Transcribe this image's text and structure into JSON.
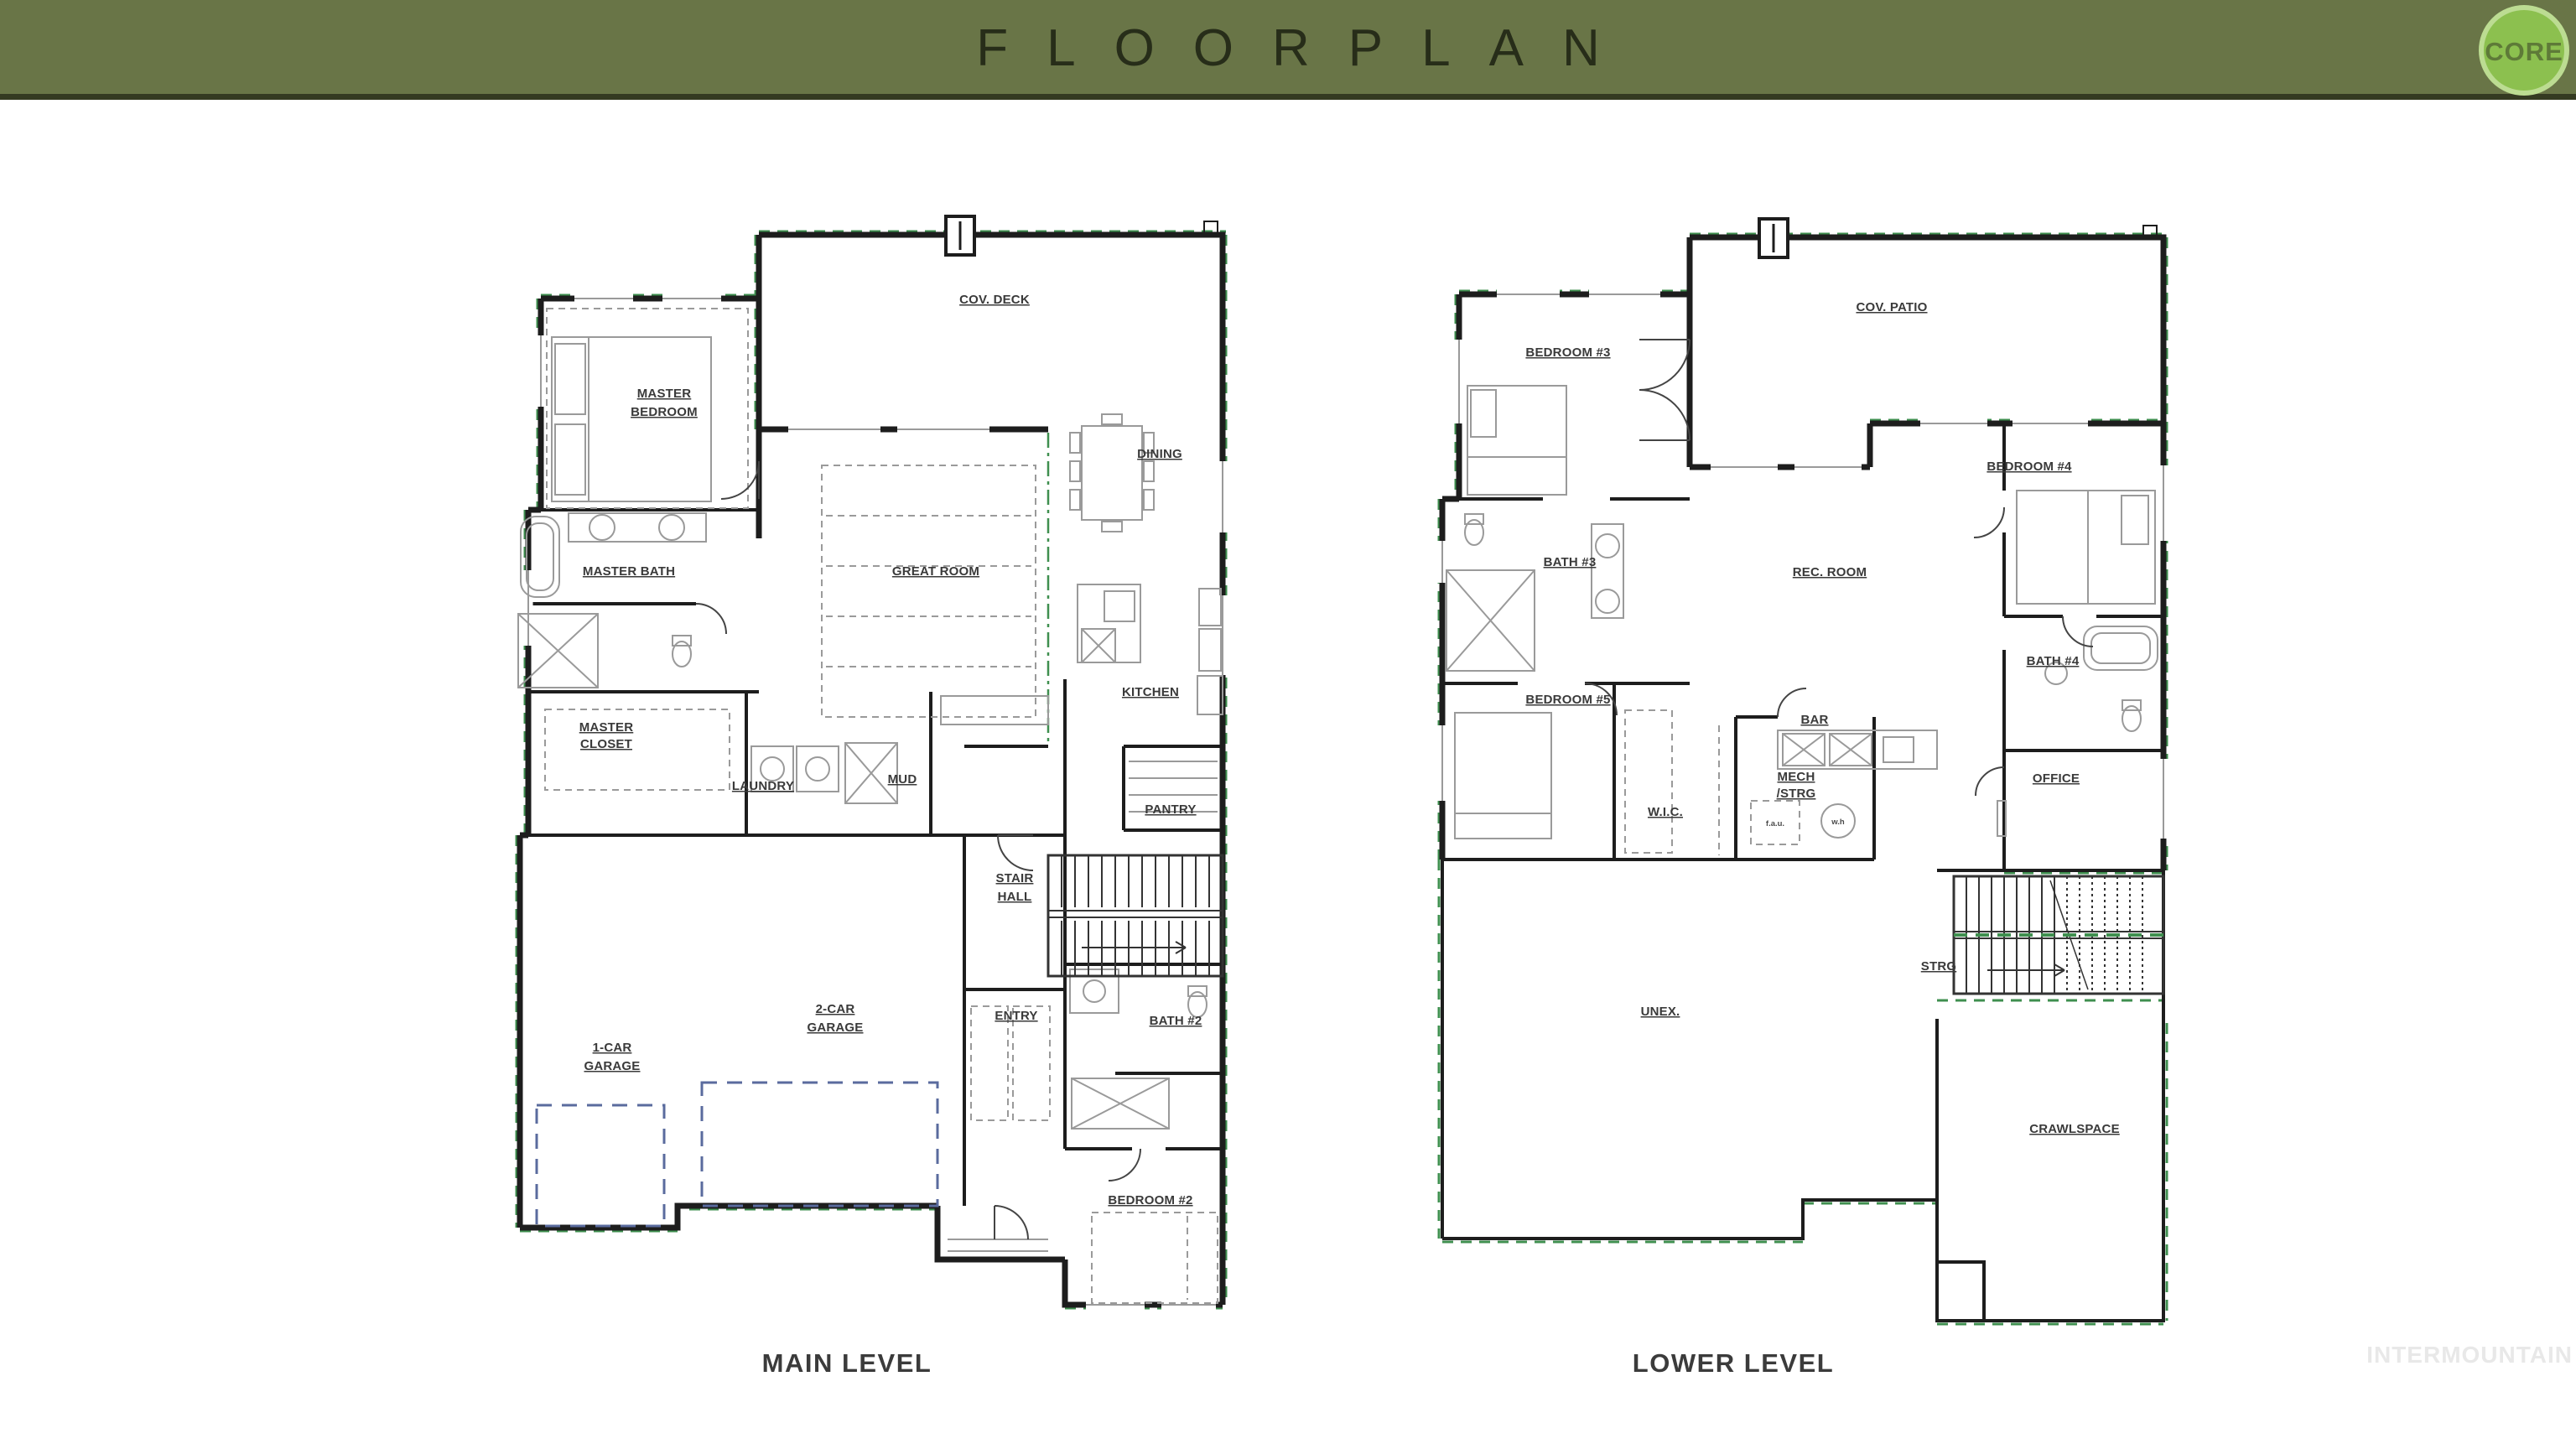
{
  "header": {
    "title": "FLOORPLAN",
    "logo": "CORE"
  },
  "watermark": "INTERMOUNTAIN",
  "palette": {
    "header_bg": "#697547",
    "header_border": "#343a21",
    "header_text": "#272d19",
    "logo_circle_fill": "#8cc04f",
    "logo_ring": "#bcdc92",
    "logo_text": "#5e7a38",
    "wall": "#1d1d1d",
    "accent_green": "#3f8f4f",
    "driveway_blue": "#5a6b9e",
    "label_gray": "#3a3a3a",
    "watermark_gray": "#e8e8e8"
  },
  "plans": [
    {
      "caption": "MAIN LEVEL",
      "rooms": [
        {
          "id": "cov-deck",
          "lines": [
            "COV. DECK"
          ]
        },
        {
          "id": "master-bedroom",
          "lines": [
            "MASTER",
            "BEDROOM"
          ]
        },
        {
          "id": "dining",
          "lines": [
            "DINING"
          ]
        },
        {
          "id": "great-room",
          "lines": [
            "GREAT ROOM"
          ]
        },
        {
          "id": "master-bath",
          "lines": [
            "MASTER BATH"
          ]
        },
        {
          "id": "kitchen",
          "lines": [
            "KITCHEN"
          ]
        },
        {
          "id": "master-closet",
          "lines": [
            "MASTER",
            "CLOSET"
          ]
        },
        {
          "id": "laundry",
          "lines": [
            "LAUNDRY"
          ]
        },
        {
          "id": "mud",
          "lines": [
            "MUD"
          ]
        },
        {
          "id": "pantry",
          "lines": [
            "PANTRY"
          ]
        },
        {
          "id": "stair-hall",
          "lines": [
            "STAIR",
            "HALL"
          ]
        },
        {
          "id": "two-car-garage",
          "lines": [
            "2-CAR",
            "GARAGE"
          ]
        },
        {
          "id": "entry",
          "lines": [
            "ENTRY"
          ]
        },
        {
          "id": "bath-2",
          "lines": [
            "BATH #2"
          ]
        },
        {
          "id": "one-car-garage",
          "lines": [
            "1-CAR",
            "GARAGE"
          ]
        },
        {
          "id": "bedroom-2",
          "lines": [
            "BEDROOM #2"
          ]
        }
      ]
    },
    {
      "caption": "LOWER LEVEL",
      "rooms": [
        {
          "id": "bedroom-3",
          "lines": [
            "BEDROOM #3"
          ]
        },
        {
          "id": "cov-patio",
          "lines": [
            "COV. PATIO"
          ]
        },
        {
          "id": "bedroom-4",
          "lines": [
            "BEDROOM #4"
          ]
        },
        {
          "id": "bath-3",
          "lines": [
            "BATH #3"
          ]
        },
        {
          "id": "rec-room",
          "lines": [
            "REC. ROOM"
          ]
        },
        {
          "id": "bedroom-5",
          "lines": [
            "BEDROOM #5"
          ]
        },
        {
          "id": "bath-4",
          "lines": [
            "BATH #4"
          ]
        },
        {
          "id": "bar",
          "lines": [
            "BAR"
          ]
        },
        {
          "id": "mech-strg",
          "lines": [
            "MECH",
            "/STRG"
          ]
        },
        {
          "id": "wic",
          "lines": [
            "W.I.C."
          ]
        },
        {
          "id": "office",
          "lines": [
            "OFFICE"
          ]
        },
        {
          "id": "strg",
          "lines": [
            "STRG"
          ]
        },
        {
          "id": "unex",
          "lines": [
            "UNEX."
          ]
        },
        {
          "id": "crawlspace",
          "lines": [
            "CRAWLSPACE"
          ]
        },
        {
          "id": "fau",
          "lines": [
            "f.a.u."
          ]
        },
        {
          "id": "wh",
          "lines": [
            "w.h"
          ]
        }
      ]
    }
  ]
}
